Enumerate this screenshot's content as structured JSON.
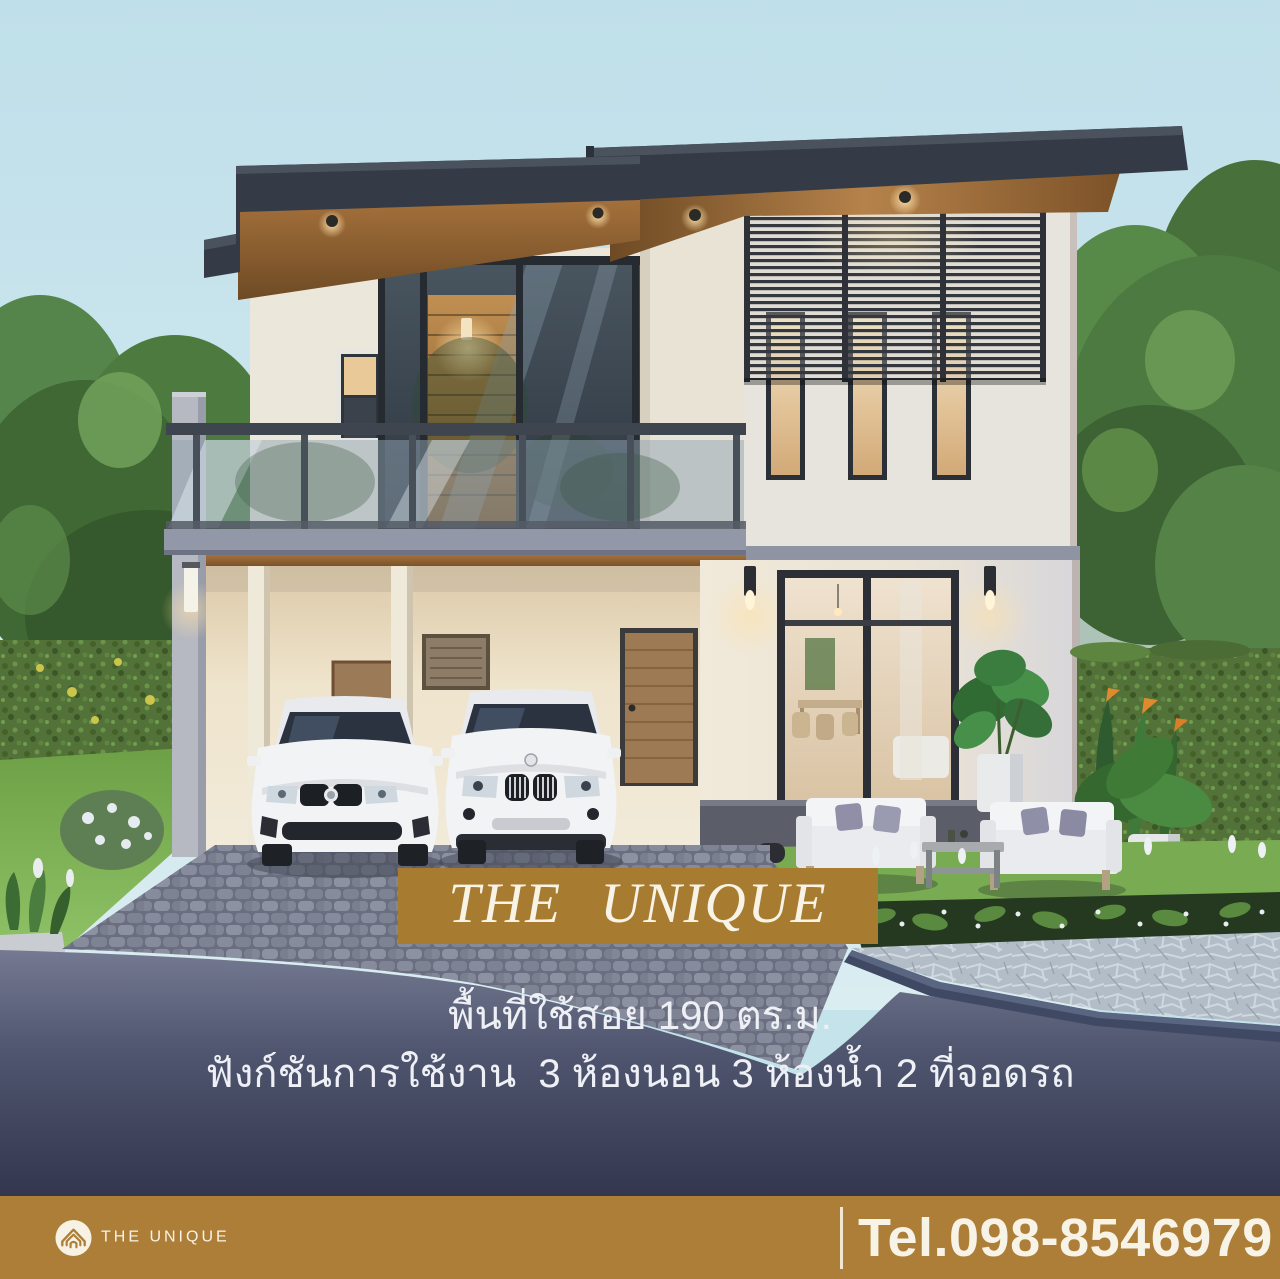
{
  "page": {
    "type": "real-estate promotional render"
  },
  "banner": {
    "title": "THE UNIQUE"
  },
  "specs": {
    "area": "พื้นที่ใช้สอย 190 ตร.ม.",
    "functions": "ฟังก์ชันการใช้งาน  3 ห้องนอน 3 ห้องน้ำ 2 ที่จอดรถ"
  },
  "footer": {
    "brand": "THE UNIQUE",
    "phone": "Tel.098-8546979"
  },
  "icons": {
    "logo": "house-logo-icon"
  },
  "colors": {
    "banner_brown": "#a87c30",
    "footer_brown": "#ad7e37",
    "cream_text": "#f8f3e7",
    "spec_text": "#eef0f6",
    "road_dark": "#383d55",
    "sky": "#c4e3eb"
  }
}
